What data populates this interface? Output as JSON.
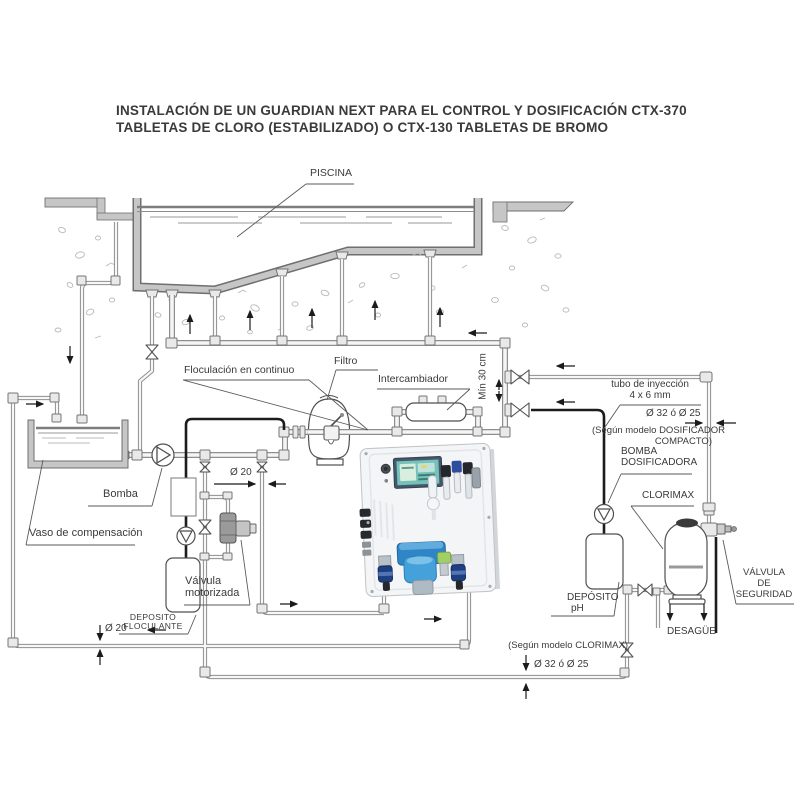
{
  "title": {
    "line1": "INSTALACIÓN DE UN GUARDIAN NEXT PARA EL CONTROL Y DOSIFICACIÓN CTX-370",
    "line2": "TABLETAS DE CLORO (ESTABILIZADO) O CTX-130 TABLETAS DE BROMO"
  },
  "labels": {
    "piscina": "PISCINA",
    "floculacion": "Floculación en continuo",
    "filtro": "Filtro",
    "intercambiador": "Intercambiador",
    "min_30_cm": "Mín 30 cm",
    "tubo_inyeccion_1": "tubo de inyección",
    "tubo_inyeccion_2": "4 x 6 mm",
    "diametro_32_25_top": "Ø 32 ó Ø 25",
    "segun_dosificador_1": "(Según modelo DOSIFICADOR",
    "segun_dosificador_2": "COMPACTO)",
    "bomba_dosificadora_1": "BOMBA",
    "bomba_dosificadora_2": "DOSIFICADORA",
    "clorimax": "CLORIMAX",
    "valvula_seguridad_1": "VÁLVULA",
    "valvula_seguridad_2": "DE",
    "valvula_seguridad_3": "SEGURIDAD",
    "deposito_ph_1": "DEPÓSITO",
    "deposito_ph_2": "pH",
    "desague": "DESAGÜE",
    "segun_clorimax": "(Según modelo CLORIMAX)",
    "diametro_32_25_bottom": "Ø 32 ó Ø 25",
    "bomba": "Bomba",
    "vaso_compensacion": "Vaso de compensación",
    "diametro_20_analisis": "Ø 20",
    "valvula_motorizada_1": "Válvula",
    "valvula_motorizada_2": "motorizada",
    "deposito_floculante_1": "DEPOSITO",
    "deposito_floculante_2": "FLOCULANTE",
    "diametro_20_retorno": "Ø 20"
  },
  "colors": {
    "line": "#4f4f4f",
    "pipe_edge": "#8e8e8e",
    "pipe_fill": "#f5f5f5",
    "concrete": "#c6c6c6",
    "text": "#3a3a3a",
    "injection_tube": "#1c1c1c",
    "panel_screen": "#74c2ba",
    "panel_blue": "#2f86c6"
  }
}
